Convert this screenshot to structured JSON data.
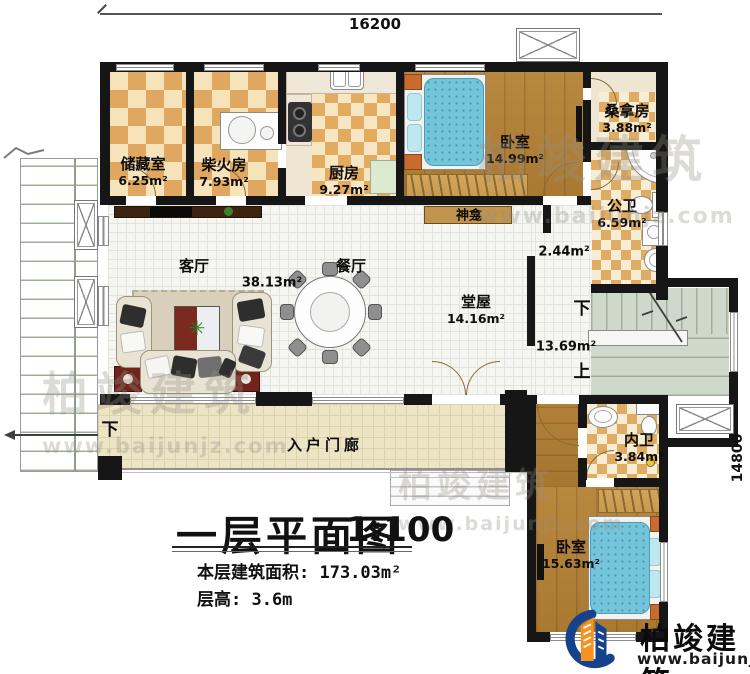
{
  "dimensions": {
    "top": "16200",
    "right": "14800"
  },
  "rooms": [
    {
      "name": "储藏室",
      "area": "6.25m²"
    },
    {
      "name": "柴火房",
      "area": "7.93m²"
    },
    {
      "name": "厨房",
      "area": "9.27m²"
    },
    {
      "name": "卧室",
      "area": "14.99m²"
    },
    {
      "name": "桑拿房",
      "area": "3.88m²"
    },
    {
      "name": "公卫",
      "area": "6.59m²"
    },
    {
      "name": "客厅",
      "area": "38.13m²"
    },
    {
      "name": "餐厅",
      "area": ""
    },
    {
      "name": "堂屋",
      "area": "14.16m²"
    },
    {
      "name": "内卫",
      "area": "3.84m²"
    },
    {
      "name": "卧室",
      "area": "15.63m²"
    }
  ],
  "annotations": {
    "shrine": "神龛",
    "porch": "入户门廊",
    "porch_down": "下",
    "stair_down": "下",
    "stair_up": "上",
    "corridor_area": "2.44m²",
    "stair_area": "13.69m²"
  },
  "title_block": {
    "title": "一层平面图",
    "scale": "1:100",
    "area_line": "本层建筑面积: 173.03m²",
    "height_line": "层高: 3.6m"
  },
  "brand": {
    "name": "柏竣建筑",
    "reg": "®",
    "website": "www.baijunjz.com",
    "blue": "#16418c",
    "orange": "#f6921e"
  },
  "watermark": {
    "text": "柏竣建筑",
    "url": "www.baijunjz.com"
  }
}
